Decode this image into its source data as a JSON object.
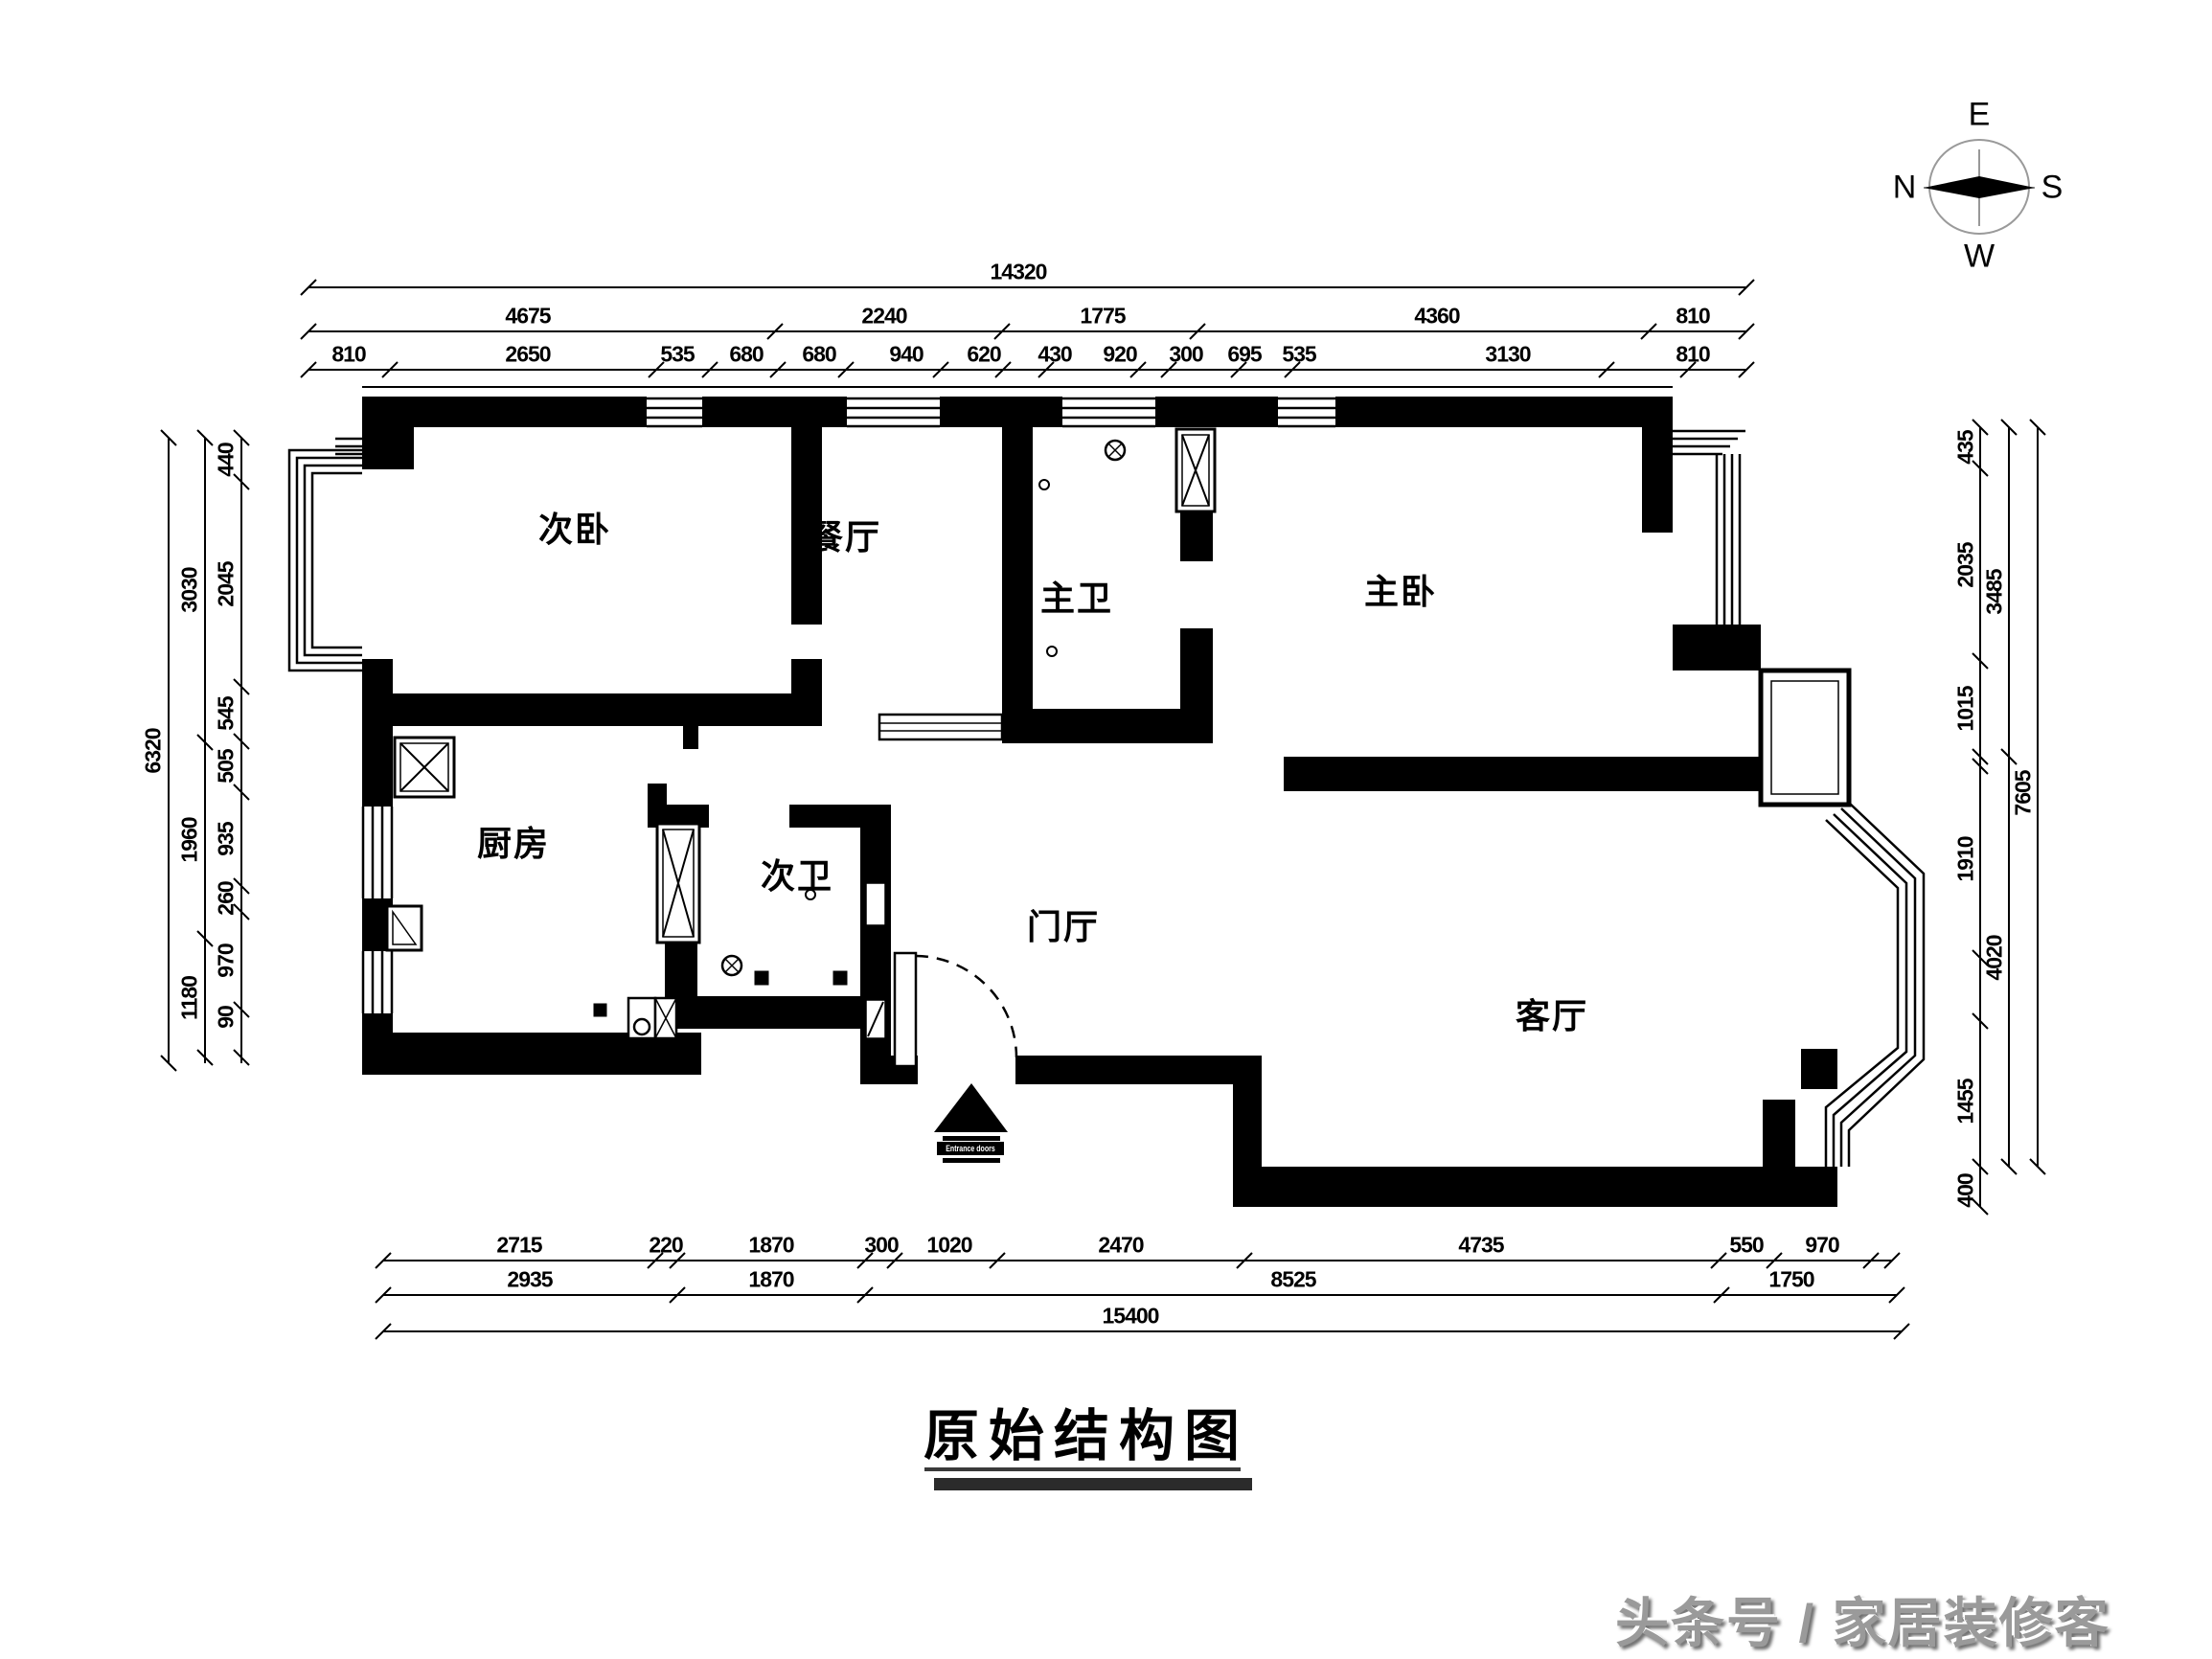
{
  "title": {
    "text": "原始结构图"
  },
  "watermark": {
    "text": "头条号 / 家居装修客"
  },
  "compass": {
    "east": "E",
    "north": "N",
    "south": "S",
    "west": "W"
  },
  "rooms": {
    "bedroom2": "次卧",
    "dining": "餐厅",
    "master_bath": "主卫",
    "master_bedroom": "主卧",
    "kitchen": "厨房",
    "bath2": "次卫",
    "foyer": "门厅",
    "living": "客厅"
  },
  "entrance": {
    "label": "Entrance doors"
  },
  "dims": {
    "top": {
      "total": "14320",
      "row2": [
        "4675",
        "2240",
        "1775",
        "4360",
        "810"
      ],
      "row3": [
        "810",
        "2650",
        "535",
        "680",
        "680",
        "940",
        "620",
        "430",
        "920",
        "300",
        "695",
        "535",
        "3130",
        "810"
      ]
    },
    "left": {
      "total": "6320",
      "mid": [
        "3030",
        "1960",
        "1180"
      ],
      "inner": [
        "440",
        "2045",
        "545",
        "505",
        "935",
        "260",
        "970",
        "90"
      ]
    },
    "right": {
      "total": "7605",
      "mid": [
        "3485",
        "4020"
      ],
      "inner": [
        "435",
        "2035",
        "1015",
        "1910",
        "1455",
        "400"
      ]
    },
    "bottom": {
      "total": "15400",
      "row1": [
        "2715",
        "220",
        "1870",
        "300",
        "1020",
        "2470",
        "4735",
        "550",
        "970"
      ],
      "row2": [
        "2935",
        "1870",
        "8525",
        "1750"
      ]
    }
  }
}
